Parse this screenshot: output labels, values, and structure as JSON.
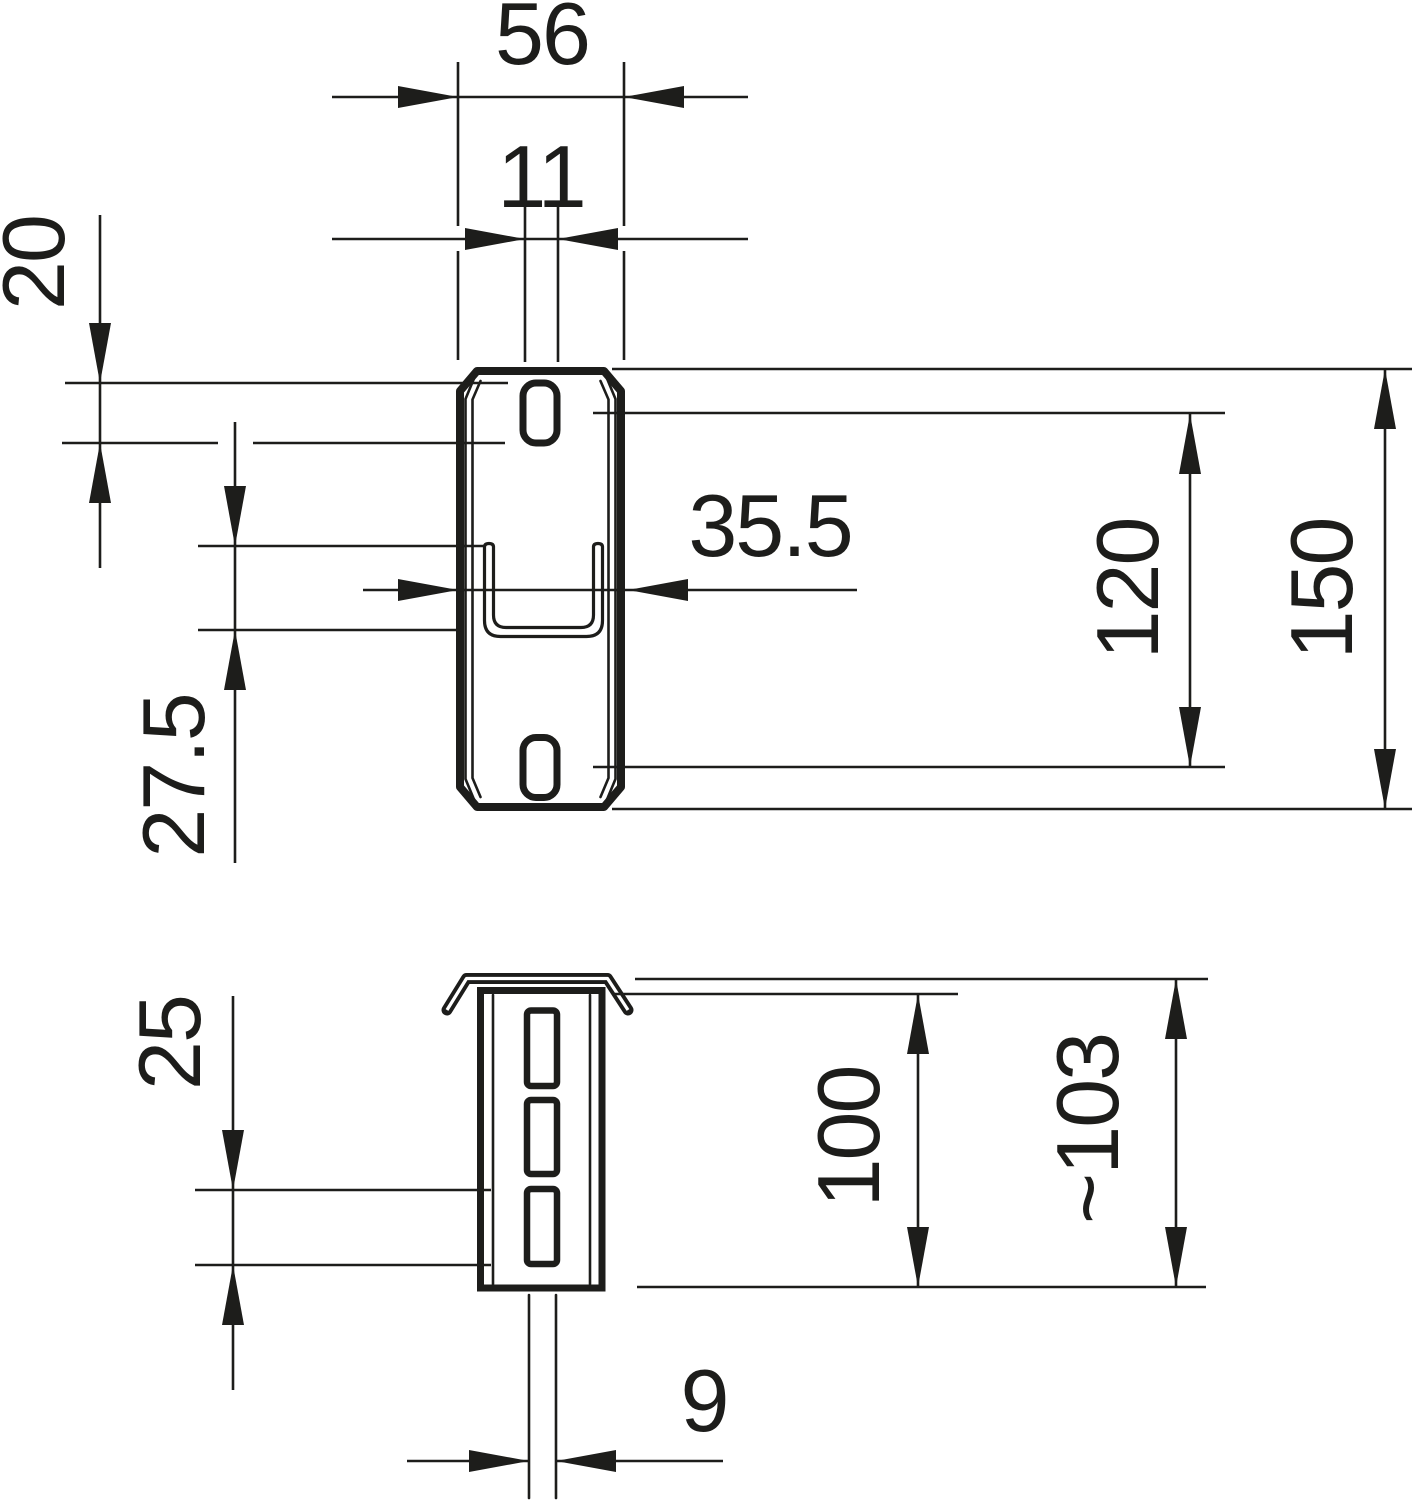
{
  "drawing": {
    "type": "technical-dimension-drawing",
    "background": "#ffffff",
    "line_color": "#1d1d1b",
    "views": {
      "front": "connector plate front view with two oblong slots and U-shaped punched notch",
      "side": "channel profile side view with flared top lip and three slots"
    },
    "dimensions": {
      "overall_width": "56",
      "slot_width": "11",
      "slot_length": "20",
      "notch_depth": "27.5",
      "notch_width": "35.5",
      "slot_spacing": "120",
      "overall_length": "150",
      "side_slot_length": "25",
      "profile_height": "100",
      "overall_height": "~103",
      "tail_gap": "9"
    }
  }
}
